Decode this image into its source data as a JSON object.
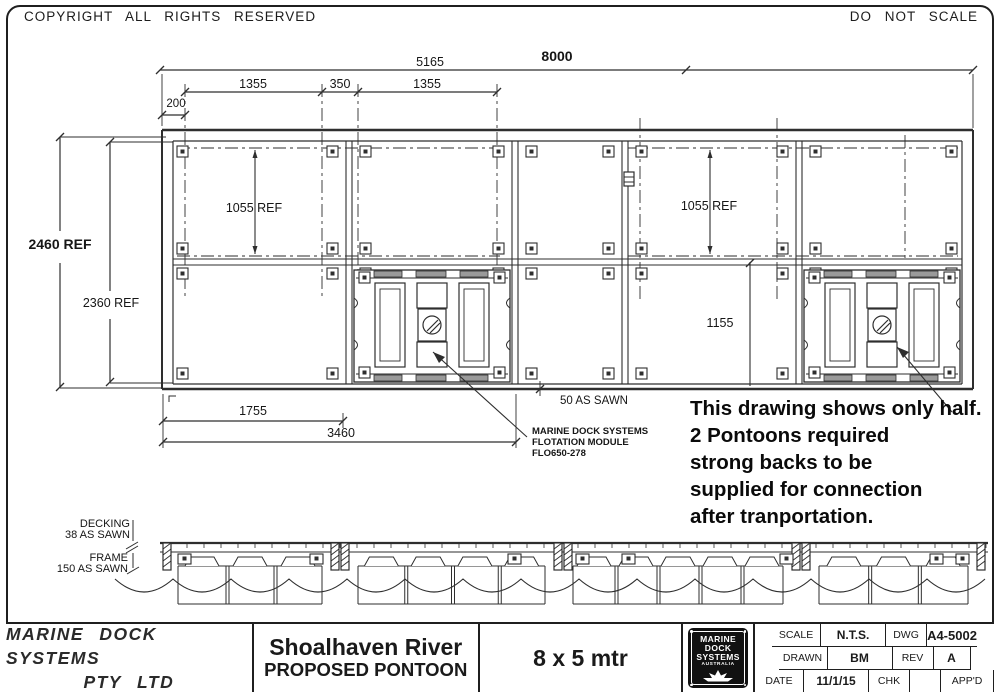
{
  "header": {
    "copyright": "COPYRIGHT ALL RIGHTS RESERVED",
    "do_not_scale": "DO NOT SCALE"
  },
  "plan": {
    "dims": {
      "d8000": "8000",
      "d5165": "5165",
      "d1355a": "1355",
      "d350": "350",
      "d1355b": "1355",
      "d200": "200",
      "d2460": "2460 REF",
      "d2360": "2360 REF",
      "d1055a": "1055 REF",
      "d1055b": "1055 REF",
      "d1155": "1155",
      "d1755": "1755",
      "d3460": "3460",
      "d50": "50 AS SAWN"
    },
    "module_label": {
      "line1": "MARINE DOCK SYSTEMS",
      "line2": "FLOTATION MODULE",
      "line3": "FLO650-278"
    }
  },
  "elevation": {
    "decking_line1": "DECKING",
    "decking_line2": "38 AS SAWN",
    "frame_line1": "FRAME",
    "frame_line2": "150 AS SAWN"
  },
  "note": {
    "lines": [
      "This drawing shows only half.",
      "2 Pontoons required",
      "strong backs to be",
      "supplied for connection",
      "after tranportation."
    ]
  },
  "titleblock": {
    "company_line1": "MARINE DOCK SYSTEMS",
    "company_line2": "PTY LTD",
    "project_line1": "Shoalhaven River",
    "project_line2": "PROPOSED PONTOON",
    "size": "8 x 5 mtr",
    "logo": {
      "line1": "MARINE",
      "line2": "DOCK",
      "line3": "SYSTEMS",
      "line4": "AUSTRALIA"
    },
    "fields": {
      "scale_label": "SCALE",
      "scale": "N.T.S.",
      "dwg_label": "DWG",
      "dwg": "A4-5002",
      "drawn_label": "DRAWN",
      "drawn": "BM",
      "rev_label": "REV",
      "rev": "A",
      "date_label": "DATE",
      "date": "11/1/15",
      "chk_label": "CHK",
      "appd_label": "APP'D"
    }
  },
  "colors": {
    "line": "#2e2e2e",
    "background": "#ffffff"
  }
}
